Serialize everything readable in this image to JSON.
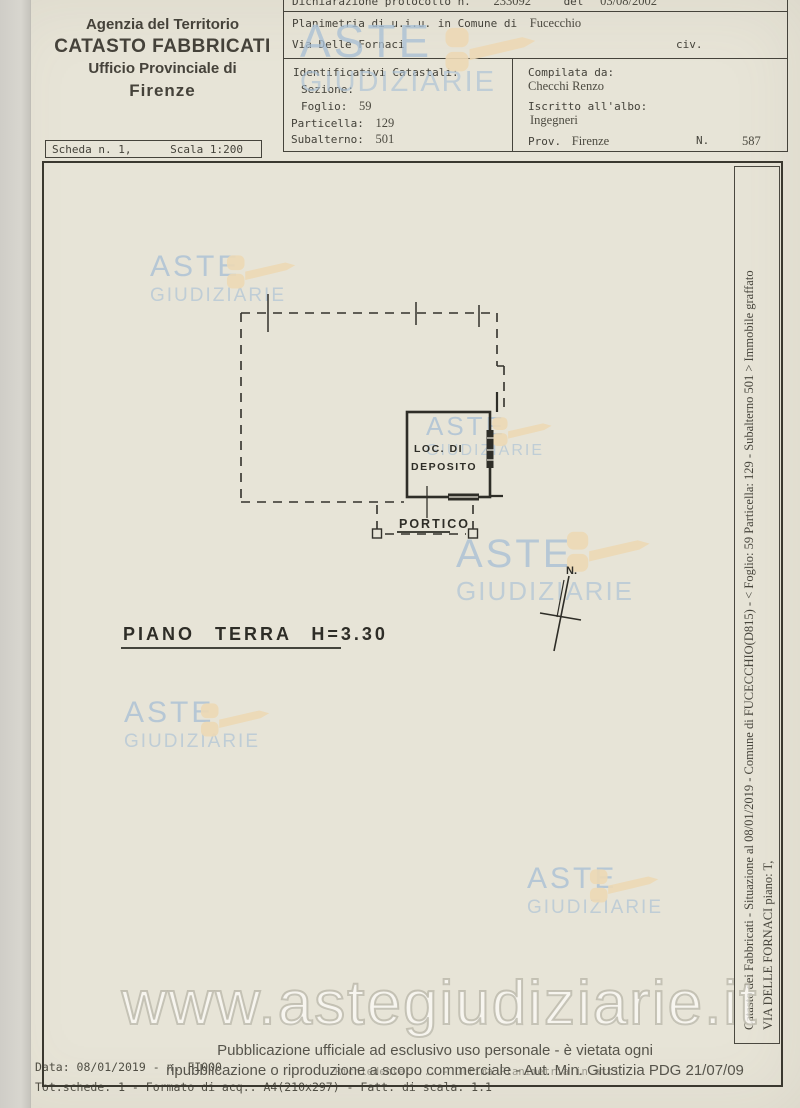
{
  "header_left": {
    "line1": "Agenzia del Territorio",
    "line2": "CATASTO FABBRICATI",
    "line3": "Ufficio Provinciale di",
    "line4": "Firenze"
  },
  "scheda": {
    "scheda": "Scheda n. 1,",
    "scala": "Scala 1:200"
  },
  "declaration": {
    "label": "Dichiarazione protocollo n.",
    "number": "233092",
    "del": "del",
    "date": "03/08/2002"
  },
  "object": {
    "planimetria": "Planimetria di u.i.u. in Comune di",
    "comune": "Fucecchio",
    "via": "Via Delle Fornaci",
    "civ": "civ."
  },
  "identificativi": {
    "title": "Identificativi Catastali:",
    "sezione_label": "Sezione:",
    "foglio_label": "Foglio:",
    "foglio": "59",
    "particella_label": "Particella:",
    "particella": "129",
    "subalterno_label": "Subalterno:",
    "subalterno": "501"
  },
  "compilata": {
    "title": "Compilata da:",
    "name": "Checchi Renzo",
    "albo_label": "Iscritto all'albo:",
    "albo": "Ingegneri",
    "prov_label": "Prov.",
    "prov": "Firenze",
    "n_label": "N.",
    "n_value": "587"
  },
  "plan": {
    "room_line1": "LOC. DI",
    "room_line2": "DEPOSITO",
    "portico": "PORTICO",
    "floor": "PIANO TERRA H=3.30",
    "north": "N."
  },
  "watermark": {
    "line1": "ASTE",
    "line2": "GIUDIZIARIE",
    "url": "www.astegiudiziarie.it",
    "text_color": "#a9c0d5",
    "gavel_color": "#edd9b5"
  },
  "side_note": {
    "line1": "Catasto dei Fabbricati - Situazione al 08/01/2019 - Comune di FUCECCHIO(D815) - < Foglio: 59 Particella: 129 - Subalterno 501 > Immobile graffato",
    "line2": "VIA DELLE FORNACI piano: T,"
  },
  "footer": {
    "official1": "Pubblicazione ufficiale ad esclusivo uso personale - è vietata ogni",
    "official2": "ripubblicazione o riproduzione a scopo commerciale - Aut. Min. Giustizia PDG 21/07/09",
    "data_line": "Data: 08/01/2019 -  n. FI000",
    "data_line_faint": "Richiedente: ... - Ultima Planimetria in atti",
    "tot_line": "Tot.schede: 1 - Formato di acq.: A4(210x297) - Fatt. di scala: 1:1"
  }
}
